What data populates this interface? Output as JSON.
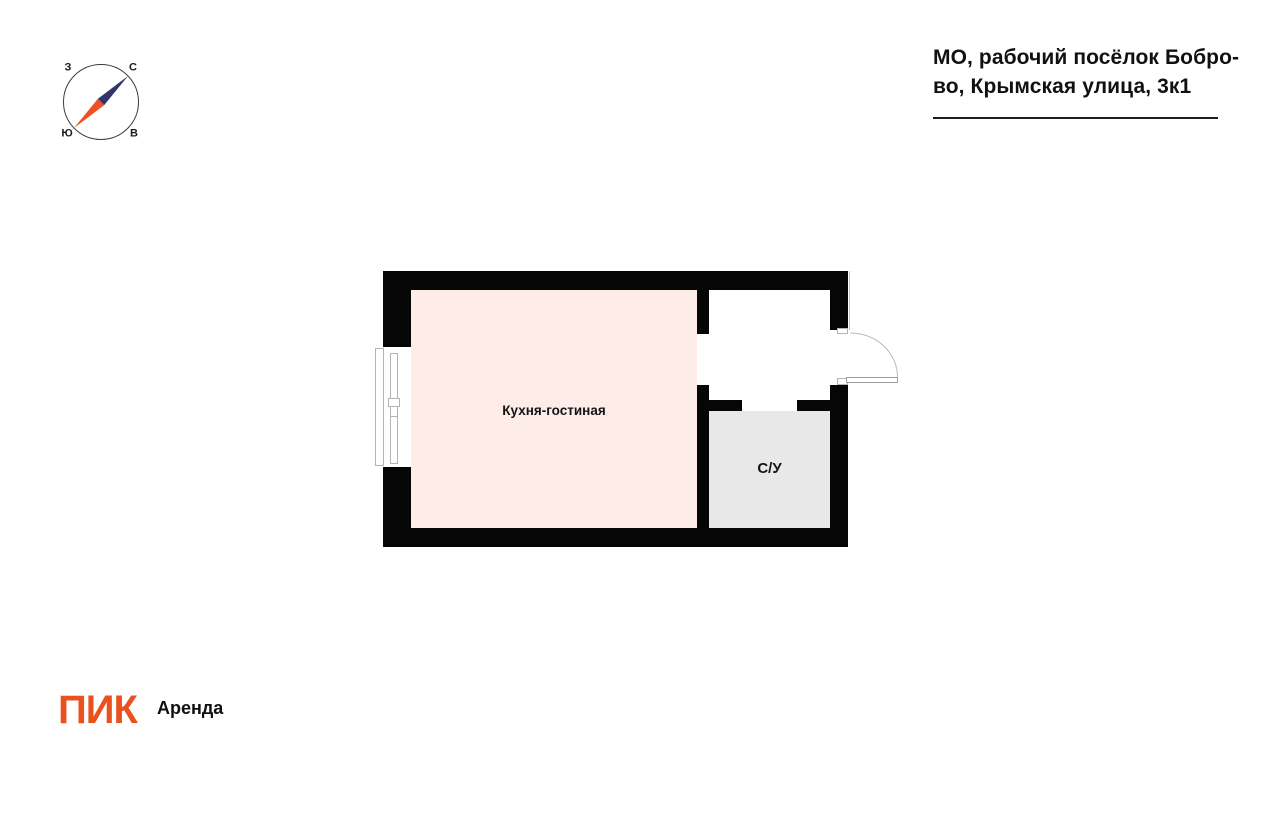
{
  "header": {
    "address_line1": "МО, рабочий посёлок Бобро-",
    "address_line2": "во, Крымская улица, 3к1"
  },
  "compass": {
    "north_label": "С",
    "south_label": "Ю",
    "west_label": "З",
    "east_label": "В",
    "needle_north_color": "#32356a",
    "needle_south_color": "#f05023"
  },
  "floorplan": {
    "wall_color": "#060606",
    "rooms": [
      {
        "name": "Кухня-гостиная",
        "color": "#fdece8"
      },
      {
        "name": "С/У",
        "color": "#e8e8e9"
      }
    ]
  },
  "footer": {
    "logo_text": "ПИК",
    "logo_color": "#e9511f",
    "logo_suffix": "Аренда"
  }
}
